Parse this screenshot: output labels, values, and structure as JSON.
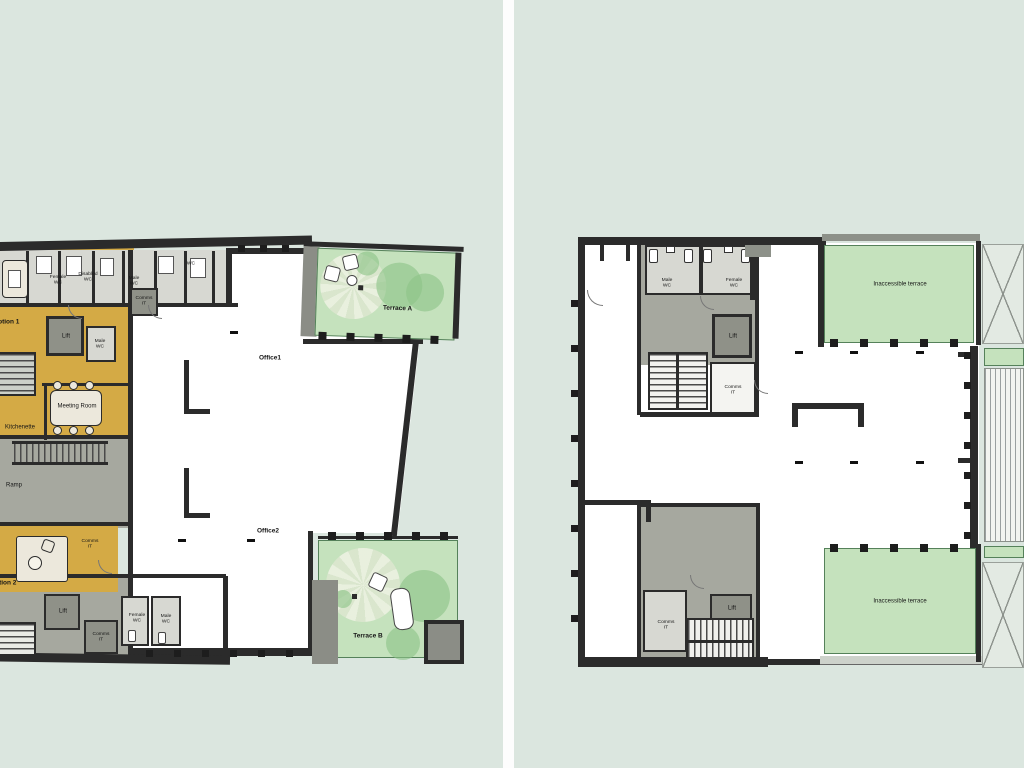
{
  "background": "#dbe6df",
  "palette": {
    "wall": "#2b2b2b",
    "yellow_room": "#d4aa45",
    "gray_circulation": "#a6a89f",
    "light_room": "#d7d8d2",
    "terrace_green": "#c5e2bd",
    "tree_green": "#8cc487",
    "white_office": "#ffffff"
  },
  "left_plan": {
    "labels": {
      "reception1": "Reception 1",
      "wc_female_top": "Female WC",
      "wc_disabled": "Disabled WC",
      "wc_male_top": "Male WC",
      "wc_top_right": "WC",
      "comms_top": "Comms IT",
      "lift_upper": "Lift",
      "wc_male_mid": "Male WC",
      "meeting_room": "Meeting Room",
      "kitchenette": "Kitchenette",
      "ramp": "Ramp",
      "comms_mid": "Comms IT",
      "reception2": "Reception 2",
      "lift_lower": "Lift",
      "comms_lower": "Comms IT",
      "wc_female_bottom": "Female WC",
      "wc_male_bottom": "Male WC",
      "office1": "Office1",
      "office2": "Office2",
      "terrace_a": "Terrace A",
      "terrace_b": "Terrace B"
    }
  },
  "right_plan": {
    "labels": {
      "wc_male": "Male WC",
      "wc_female": "Female WC",
      "lift_upper": "Lift",
      "comms_upper": "Comms IT",
      "terrace_top": "Inaccessible terrace",
      "terrace_bottom": "Inaccessible terrace",
      "comms_lower": "Comms IT",
      "lift_lower": "Lift"
    }
  }
}
